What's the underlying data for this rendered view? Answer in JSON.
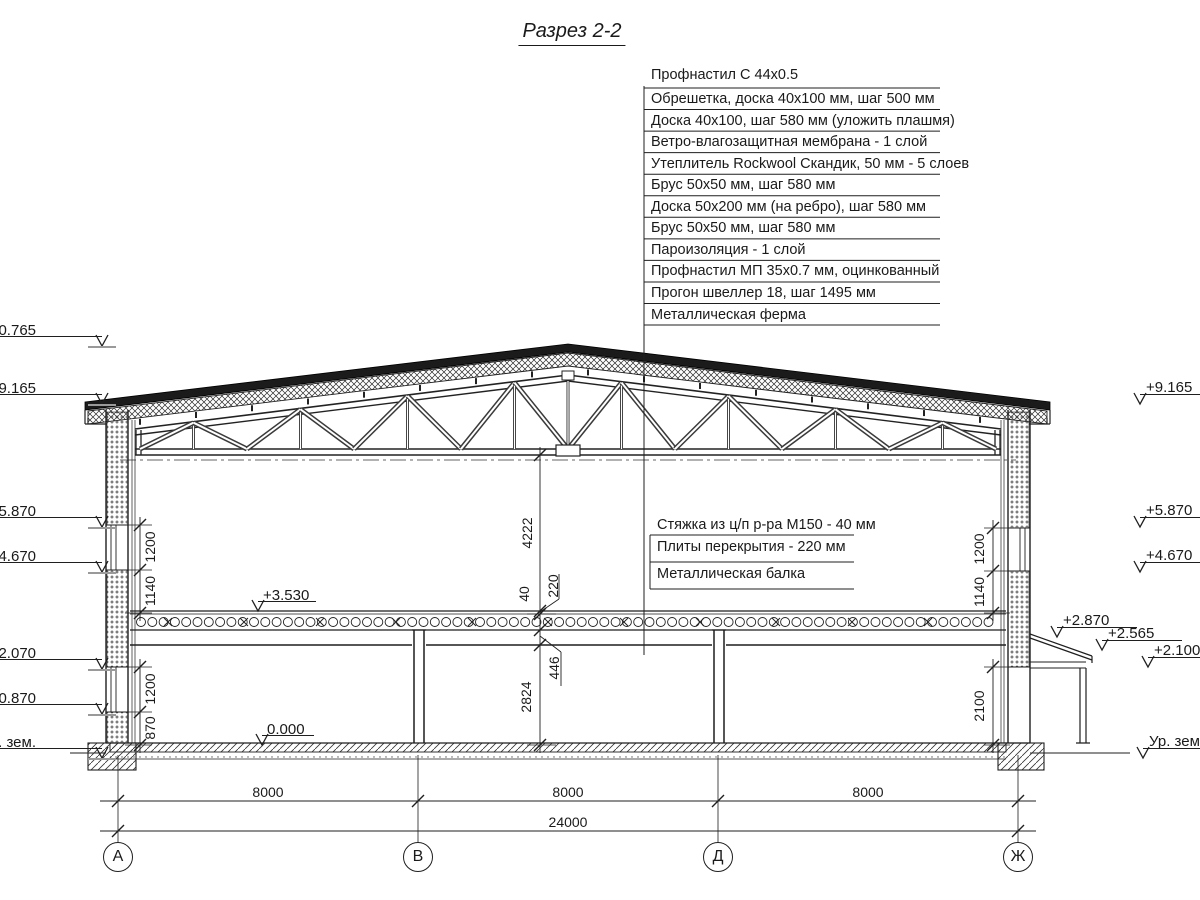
{
  "title": "Разрез 2-2",
  "roof_callouts": [
    "Профнастил С 44х0.5",
    "Обрешетка, доска 40х100 мм, шаг 500 мм",
    "Доска 40х100, шаг 580 мм (уложить плашмя)",
    "Ветро-влагозащитная мембрана - 1 слой",
    "Утеплитель Rockwool Скандик, 50 мм - 5 слоев",
    "Брус 50х50 мм, шаг 580 мм",
    "Доска 50х200 мм (на ребро), шаг 580 мм",
    "Брус 50х50 мм, шаг 580 мм",
    "Пароизоляция - 1 слой",
    "Профнастил МП 35х0.7 мм, оцинкованный",
    "Прогон швеллер 18, шаг 1495 мм",
    "Металлическая ферма"
  ],
  "floor_callouts": [
    "Стяжка из ц/п р-ра М150 - 40 мм",
    "Плиты перекрытия - 220 мм",
    "Металлическая балка"
  ],
  "elevations_left": [
    {
      "label": "+10.765",
      "level": 346
    },
    {
      "label": "+9.165",
      "level": 404
    },
    {
      "label": "+5.870",
      "level": 527
    },
    {
      "label": "+4.670",
      "level": 572
    },
    {
      "label": "+2.070",
      "level": 669
    },
    {
      "label": "+0.870",
      "level": 714
    },
    {
      "label": "Ур. зем.",
      "level": 758
    }
  ],
  "elevations_right": [
    {
      "label": "+9.165",
      "level": 404,
      "x": 1140,
      "len": 60
    },
    {
      "label": "+5.870",
      "level": 527,
      "x": 1140,
      "len": 60
    },
    {
      "label": "+4.670",
      "level": 572,
      "x": 1140,
      "len": 60
    },
    {
      "label": "+2.870",
      "level": 637,
      "x": 1057,
      "len": 80
    },
    {
      "label": "+2.565",
      "level": 650,
      "x": 1102,
      "len": 80
    },
    {
      "label": "+2.100",
      "level": 667,
      "x": 1148,
      "len": 55
    },
    {
      "label": "Ур. зем.",
      "level": 758,
      "x": 1143,
      "len": 57
    }
  ],
  "interior_elevations": [
    {
      "label": "+3.530",
      "x": 258,
      "level": 611,
      "len": 58
    },
    {
      "label": "0.000",
      "x": 262,
      "level": 745,
      "len": 52
    }
  ],
  "dim_groups": [
    {
      "name": "left-upper",
      "x": 140,
      "ticks": [
        525,
        570,
        613
      ],
      "ext": [
        125,
        152
      ],
      "labels": [
        {
          "text": "1200",
          "mid": 547,
          "lx": 150
        },
        {
          "text": "1140",
          "mid": 591,
          "lx": 150
        }
      ]
    },
    {
      "name": "left-lower",
      "x": 140,
      "ticks": [
        667,
        712,
        745
      ],
      "ext": [
        125,
        152
      ],
      "labels": [
        {
          "text": "1200",
          "mid": 689,
          "lx": 150
        },
        {
          "text": "870",
          "mid": 728,
          "lx": 150
        }
      ]
    },
    {
      "name": "right-upper",
      "x": 993,
      "ticks": [
        528,
        571,
        613
      ],
      "ext": [
        984,
        1010
      ],
      "labels": [
        {
          "text": "1200",
          "mid": 549,
          "lx": 979
        },
        {
          "text": "1140",
          "mid": 592,
          "lx": 979
        }
      ]
    },
    {
      "name": "right-lower",
      "x": 993,
      "ticks": [
        667,
        745
      ],
      "ext": [
        984,
        1010
      ],
      "labels": [
        {
          "text": "2100",
          "mid": 706,
          "lx": 979
        }
      ]
    },
    {
      "name": "center",
      "x": 540,
      "ticks": [
        455,
        611,
        614,
        630,
        645,
        745
      ],
      "ext": [
        527,
        556
      ],
      "labels": [
        {
          "text": "4222",
          "mid": 533,
          "lx": 527
        },
        {
          "text": "40",
          "mid": 594,
          "lx": 524
        },
        {
          "text": "220",
          "mid": 586,
          "lx": 553
        },
        {
          "text": "446",
          "mid": 668,
          "lx": 554
        },
        {
          "text": "2824",
          "mid": 697,
          "lx": 526
        }
      ]
    }
  ],
  "bottom_dims": {
    "spans": [
      {
        "label": "8000",
        "cx": 268
      },
      {
        "label": "8000",
        "cx": 568
      },
      {
        "label": "8000",
        "cx": 868
      }
    ],
    "total": {
      "label": "24000",
      "cx": 568
    }
  },
  "axes": [
    {
      "label": "А",
      "x": 118
    },
    {
      "label": "В",
      "x": 418
    },
    {
      "label": "Д",
      "x": 718
    },
    {
      "label": "Ж",
      "x": 1018
    }
  ]
}
